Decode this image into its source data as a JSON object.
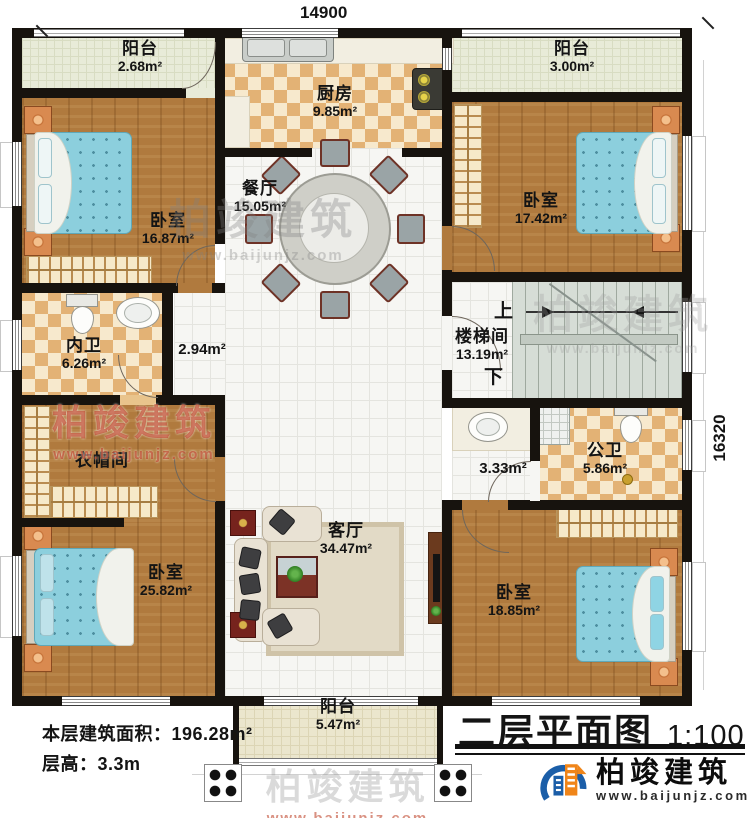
{
  "meta": {
    "width_dim": "14900",
    "height_dim": "16320"
  },
  "rooms": {
    "balcony_tl": {
      "name": "阳台",
      "area": "2.68m²"
    },
    "kitchen": {
      "name": "厨房",
      "area": "9.85m²"
    },
    "balcony_tr": {
      "name": "阳台",
      "area": "3.00m²"
    },
    "bedroom_tl": {
      "name": "卧室",
      "area": "16.87m²"
    },
    "dining": {
      "name": "餐厅",
      "area": "15.05m²"
    },
    "bedroom_tr": {
      "name": "卧室",
      "area": "17.42m²"
    },
    "bath_inner": {
      "name": "内卫",
      "area": "6.26m²"
    },
    "hall_left": {
      "area": "2.94m²"
    },
    "stair": {
      "name": "楼梯间",
      "area": "13.19m²",
      "up": "上",
      "down": "下"
    },
    "cloakroom": {
      "name": "衣帽间"
    },
    "living": {
      "name": "客厅",
      "area": "34.47m²"
    },
    "hall_right": {
      "area": "3.33m²"
    },
    "bath_public": {
      "name": "公卫",
      "area": "5.86m²"
    },
    "bedroom_bl": {
      "name": "卧室",
      "area": "25.82m²"
    },
    "bedroom_br": {
      "name": "卧室",
      "area": "18.85m²"
    },
    "balcony_b": {
      "name": "阳台",
      "area": "5.47m²"
    }
  },
  "stats": {
    "floor_area": "本层建筑面积：196.28m²",
    "floor_height": "层高：3.3m"
  },
  "title": {
    "text": "二层平面图",
    "scale": "1:100"
  },
  "brand": {
    "name": "柏竣建筑",
    "url": "www.baijunjz.com"
  },
  "watermark": {
    "name": "柏竣建筑",
    "url": "www.baijunjz.com"
  }
}
